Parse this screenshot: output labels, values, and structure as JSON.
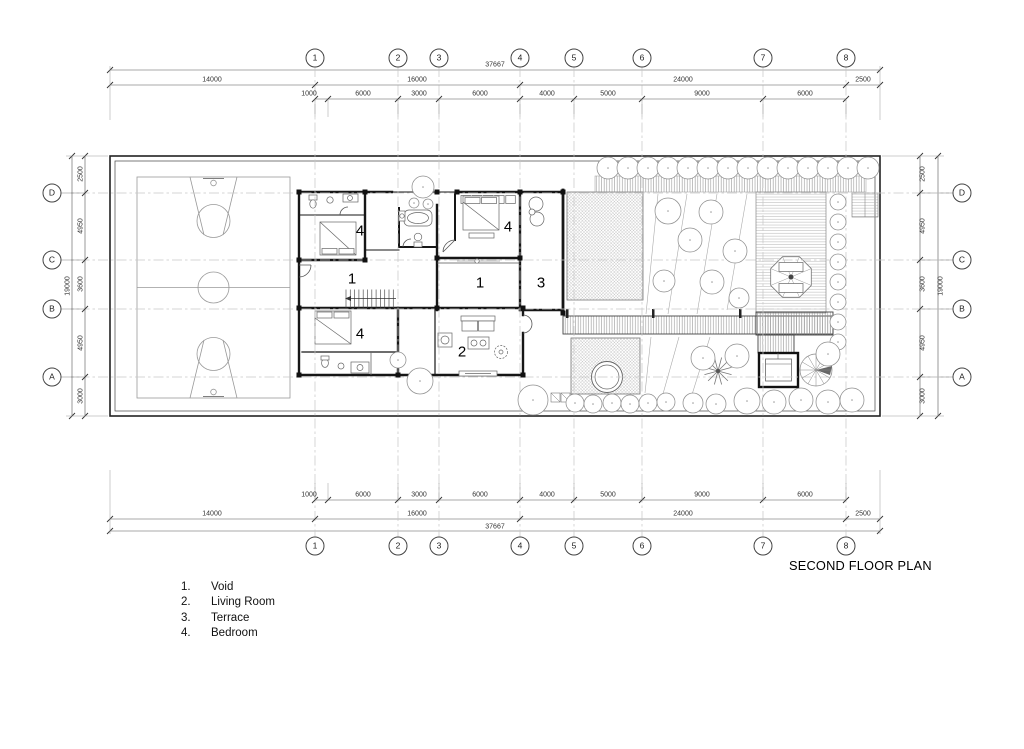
{
  "title": "SECOND FLOOR PLAN",
  "colors": {
    "paper": "#ffffff",
    "ink": "#1a1a1a"
  },
  "legend": {
    "items": [
      {
        "num": "1.",
        "label": "Void"
      },
      {
        "num": "2.",
        "label": "Living Room"
      },
      {
        "num": "3.",
        "label": "Terrace"
      },
      {
        "num": "4.",
        "label": "Bedroom"
      }
    ]
  },
  "grid": {
    "columns": {
      "labels": [
        "1",
        "2",
        "3",
        "4",
        "5",
        "6",
        "7",
        "8"
      ],
      "x": [
        315,
        398,
        439,
        520,
        574,
        642,
        763,
        846
      ],
      "top_y": 58,
      "bottom_y": 546
    },
    "rows": {
      "labels": [
        "D",
        "C",
        "B",
        "A"
      ],
      "y": [
        193,
        260,
        309,
        377
      ],
      "left_x": 52,
      "right_x": 962
    }
  },
  "dimensions": {
    "top": {
      "total": {
        "t": "37667",
        "x": 495,
        "y": 65
      },
      "majors": [
        {
          "t": "14000",
          "x": 212,
          "y": 80
        },
        {
          "t": "16000",
          "x": 417,
          "y": 80
        },
        {
          "t": "24000",
          "x": 683,
          "y": 80
        },
        {
          "t": "2500",
          "x": 863,
          "y": 80
        }
      ],
      "minors": [
        {
          "t": "1000",
          "x": 309,
          "y": 94
        },
        {
          "t": "6000",
          "x": 363,
          "y": 94
        },
        {
          "t": "3000",
          "x": 419,
          "y": 94
        },
        {
          "t": "6000",
          "x": 480,
          "y": 94
        },
        {
          "t": "4000",
          "x": 547,
          "y": 94
        },
        {
          "t": "5000",
          "x": 608,
          "y": 94
        },
        {
          "t": "9000",
          "x": 702,
          "y": 94
        },
        {
          "t": "6000",
          "x": 805,
          "y": 94
        }
      ]
    },
    "bottom": {
      "total": {
        "t": "37667",
        "x": 495,
        "y": 527
      },
      "majors": [
        {
          "t": "14000",
          "x": 212,
          "y": 514
        },
        {
          "t": "16000",
          "x": 417,
          "y": 514
        },
        {
          "t": "24000",
          "x": 683,
          "y": 514
        },
        {
          "t": "2500",
          "x": 863,
          "y": 514
        }
      ],
      "minors": [
        {
          "t": "1000",
          "x": 309,
          "y": 495
        },
        {
          "t": "6000",
          "x": 363,
          "y": 495
        },
        {
          "t": "3000",
          "x": 419,
          "y": 495
        },
        {
          "t": "6000",
          "x": 480,
          "y": 495
        },
        {
          "t": "4000",
          "x": 547,
          "y": 495
        },
        {
          "t": "5000",
          "x": 608,
          "y": 495
        },
        {
          "t": "9000",
          "x": 702,
          "y": 495
        },
        {
          "t": "6000",
          "x": 805,
          "y": 495
        }
      ]
    },
    "left": {
      "total": {
        "t": "19000",
        "x": 68,
        "y": 286
      },
      "minors": [
        {
          "t": "2500",
          "x": 81,
          "y": 174
        },
        {
          "t": "4950",
          "x": 81,
          "y": 226
        },
        {
          "t": "3600",
          "x": 81,
          "y": 284
        },
        {
          "t": "4950",
          "x": 81,
          "y": 343
        },
        {
          "t": "3000",
          "x": 81,
          "y": 396
        }
      ]
    },
    "right": {
      "total": {
        "t": "19000",
        "x": 941,
        "y": 286
      },
      "minors": [
        {
          "t": "2500",
          "x": 923,
          "y": 174
        },
        {
          "t": "4950",
          "x": 923,
          "y": 226
        },
        {
          "t": "3600",
          "x": 923,
          "y": 284
        },
        {
          "t": "4950",
          "x": 923,
          "y": 343
        },
        {
          "t": "3000",
          "x": 923,
          "y": 396
        }
      ]
    }
  },
  "plan": {
    "room_labels": [
      {
        "t": "4",
        "x": 360,
        "y": 231
      },
      {
        "t": "4",
        "x": 508,
        "y": 227
      },
      {
        "t": "1",
        "x": 352,
        "y": 279
      },
      {
        "t": "1",
        "x": 480,
        "y": 283
      },
      {
        "t": "3",
        "x": 541,
        "y": 283
      },
      {
        "t": "4",
        "x": 360,
        "y": 334
      },
      {
        "t": "2",
        "x": 462,
        "y": 352
      }
    ]
  }
}
